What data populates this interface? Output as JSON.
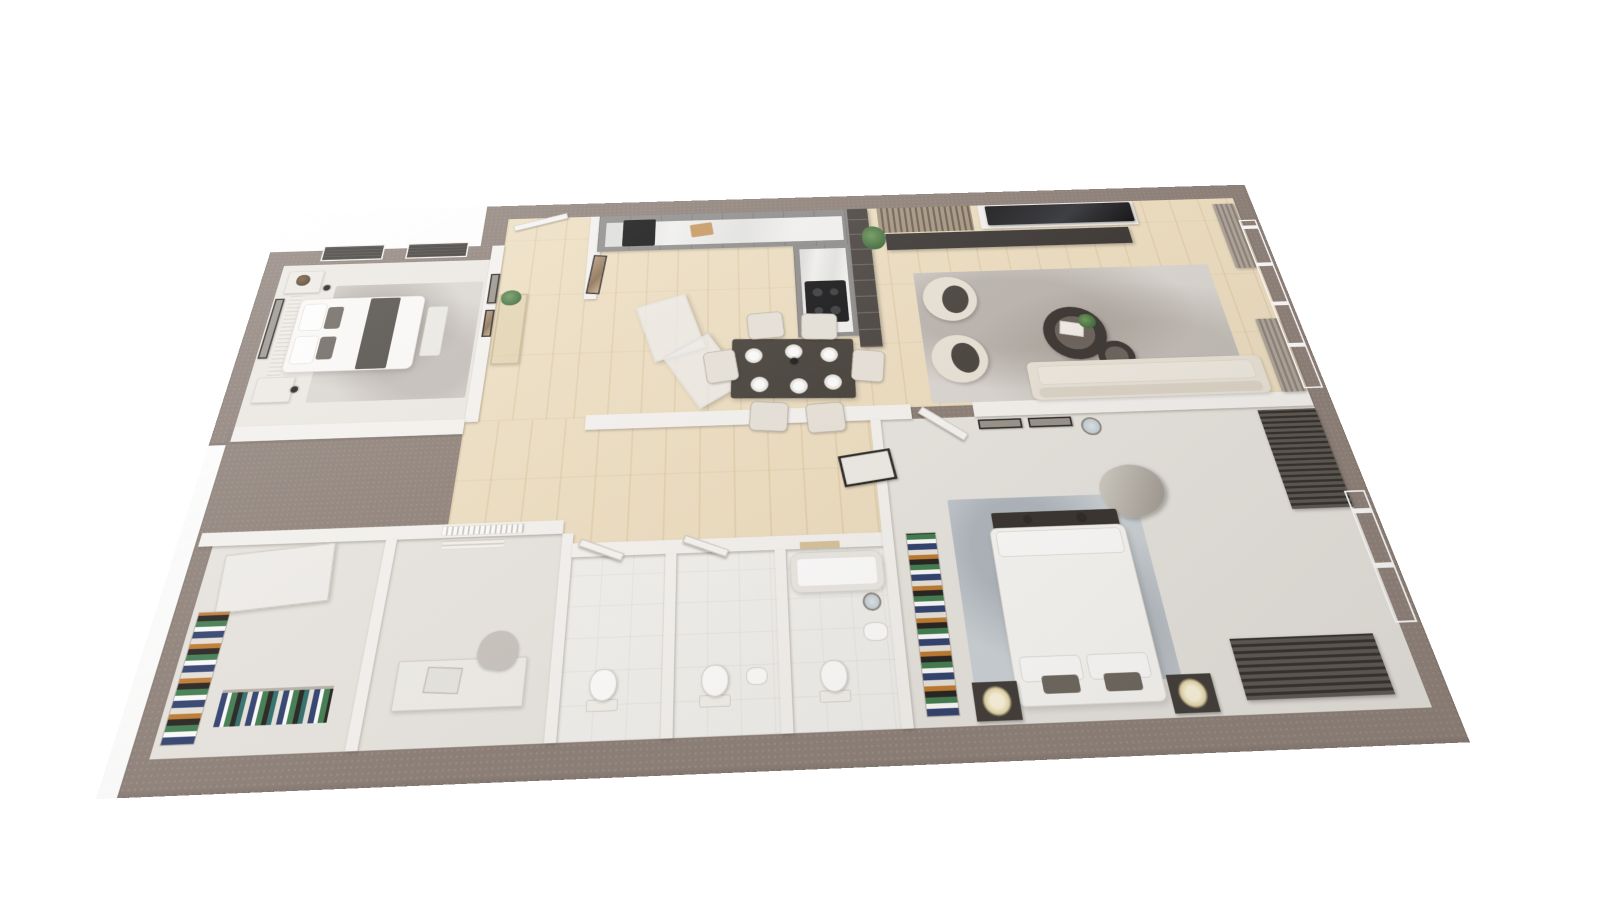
{
  "scene": {
    "description": "3D rendered top-down perspective floor plan of a two-bedroom apartment, no text labels",
    "colors": {
      "page-bg": "#ffffff",
      "wall-outer": "#8d8078",
      "wall-inner": "#f6f4f1",
      "floor-wood": "#efe0c3",
      "floor-carpet": "#edeae5",
      "floor-tile": "#f3f2ef",
      "floor-gray": "#e9e6e1",
      "rug-light": "#dcd8d3",
      "rug-blue": "#cdd4d9",
      "cabinet-gray": "#8f8e8c",
      "counter-white": "#f3f3f1",
      "cream": "#eae4d9"
    }
  },
  "plan": {
    "width": 1340,
    "height": 740,
    "transform": {
      "perspective": 760,
      "rotateX": 25.5,
      "rotateZ": -2.2,
      "scale": 0.86,
      "originX": "50%",
      "originY": "55%"
    }
  },
  "slabs": [
    {
      "name": "slab-top-band",
      "x": 280,
      "y": 0,
      "w": 1060,
      "h": 360
    },
    {
      "name": "slab-left-block",
      "x": 0,
      "y": 70,
      "w": 300,
      "h": 290
    },
    {
      "name": "slab-bottom-band",
      "x": 20,
      "y": 340,
      "w": 1320,
      "h": 400
    }
  ],
  "floors": [
    {
      "name": "bedroom-left-floor",
      "fill": "carpet",
      "x": 24,
      "y": 94,
      "w": 272,
      "h": 246
    },
    {
      "name": "entry-hall-floor",
      "fill": "wood",
      "x": 312,
      "y": 24,
      "w": 113,
      "h": 316
    },
    {
      "name": "kitchen-living-floor",
      "fill": "wood",
      "x": 425,
      "y": 24,
      "w": 891,
      "h": 316
    },
    {
      "name": "corridor-floor",
      "fill": "wood",
      "x": 296,
      "y": 340,
      "w": 484,
      "h": 170
    },
    {
      "name": "closet-room-floor",
      "fill": "gray",
      "x": 40,
      "y": 486,
      "w": 190,
      "h": 220
    },
    {
      "name": "study-room-floor",
      "fill": "gray",
      "x": 242,
      "y": 486,
      "w": 183,
      "h": 220
    },
    {
      "name": "bathroom1-floor",
      "fill": "tile",
      "x": 437,
      "y": 514,
      "w": 103,
      "h": 192
    },
    {
      "name": "bathroom2-floor",
      "fill": "tile",
      "x": 552,
      "y": 514,
      "w": 108,
      "h": 192
    },
    {
      "name": "bathroom3-floor",
      "fill": "tile",
      "x": 672,
      "y": 514,
      "w": 108,
      "h": 192
    },
    {
      "name": "master-bedroom-floor",
      "fill": "gray",
      "x": 792,
      "y": 356,
      "w": 524,
      "h": 350
    }
  ],
  "walls": [
    {
      "name": "wall-hall-left",
      "x": 296,
      "y": 70,
      "w": 16,
      "h": 270
    },
    {
      "name": "wall-hall-right-upper",
      "x": 425,
      "y": 24,
      "w": 16,
      "h": 140
    },
    {
      "name": "wall-middle-a",
      "x": 24,
      "y": 336,
      "w": 272,
      "h": 20
    },
    {
      "name": "wall-middle-b",
      "x": 440,
      "y": 336,
      "w": 390,
      "h": 20
    },
    {
      "name": "wall-middle-c",
      "x": 905,
      "y": 336,
      "w": 411,
      "h": 20
    },
    {
      "name": "wall-leftblock-top",
      "x": 24,
      "y": 470,
      "w": 401,
      "h": 16
    },
    {
      "name": "wall-closet-study",
      "x": 230,
      "y": 486,
      "w": 12,
      "h": 220
    },
    {
      "name": "wall-study-bath",
      "x": 425,
      "y": 486,
      "w": 12,
      "h": 220
    },
    {
      "name": "wall-bath-top",
      "x": 437,
      "y": 498,
      "w": 343,
      "h": 16
    },
    {
      "name": "wall-bath1-bath2",
      "x": 540,
      "y": 514,
      "w": 12,
      "h": 192
    },
    {
      "name": "wall-bath2-bath3",
      "x": 660,
      "y": 514,
      "w": 12,
      "h": 192
    },
    {
      "name": "wall-bath-master",
      "x": 780,
      "y": 356,
      "w": 12,
      "h": 350
    },
    {
      "name": "wall-tv-backing",
      "x": 958,
      "y": 24,
      "w": 216,
      "h": 42
    }
  ],
  "items": [
    {
      "name": "bedroom-left-accent-panel",
      "type": "accent-stripes",
      "x": 44,
      "y": 112,
      "w": 16,
      "h": 188
    },
    {
      "name": "bedroom-left-rug",
      "type": "rug",
      "x": 100,
      "y": 130,
      "w": 192,
      "h": 176
    },
    {
      "name": "bedroom-left-bed",
      "type": "bed",
      "x": 60,
      "y": 150,
      "w": 160,
      "h": 112
    },
    {
      "name": "bedroom-left-pillow-1",
      "type": "pillow",
      "x": 66,
      "y": 158,
      "w": 30,
      "h": 42
    },
    {
      "name": "bedroom-left-pillow-2",
      "type": "pillow",
      "x": 66,
      "y": 208,
      "w": 30,
      "h": 42
    },
    {
      "name": "bedroom-left-cushion-1",
      "type": "cushion-dark",
      "x": 98,
      "y": 164,
      "w": 20,
      "h": 34
    },
    {
      "name": "bedroom-left-cushion-2",
      "type": "cushion-dark",
      "x": 98,
      "y": 210,
      "w": 20,
      "h": 34
    },
    {
      "name": "bedroom-left-throw",
      "type": "throw",
      "x": 150,
      "y": 152,
      "w": 38,
      "h": 108
    },
    {
      "name": "bedroom-left-bench",
      "type": "bench-light",
      "x": 226,
      "y": 168,
      "w": 26,
      "h": 76
    },
    {
      "name": "bedroom-left-nightstand-1",
      "type": "nightstand",
      "x": 34,
      "y": 104,
      "w": 46,
      "h": 36
    },
    {
      "name": "bedroom-left-nightstand-2",
      "type": "nightstand",
      "x": 34,
      "y": 268,
      "w": 46,
      "h": 36
    },
    {
      "name": "bedroom-left-vase-plant",
      "type": "plant-dark",
      "x": 46,
      "y": 110,
      "w": 18,
      "h": 18
    },
    {
      "name": "bedroom-left-wall-art",
      "type": "frame-dark",
      "x": 26,
      "y": 148,
      "w": 12,
      "h": 92
    },
    {
      "name": "bedroom-left-window-blind-1",
      "type": "blind-dark",
      "x": 70,
      "y": 62,
      "w": 82,
      "h": 26
    },
    {
      "name": "bedroom-left-window-blind-2",
      "type": "blind-dark",
      "x": 182,
      "y": 62,
      "w": 82,
      "h": 26
    },
    {
      "name": "bedroom-left-pendant-1",
      "type": "pendant",
      "x": 84,
      "y": 128,
      "w": 9,
      "h": 9
    },
    {
      "name": "bedroom-left-pendant-2",
      "type": "pendant",
      "x": 78,
      "y": 282,
      "w": 9,
      "h": 9
    },
    {
      "name": "entry-door-leaf",
      "type": "door-leaf",
      "x": 320,
      "y": 26,
      "w": 74,
      "h": 10,
      "rot": -16
    },
    {
      "name": "entry-console-table",
      "type": "console-glass",
      "x": 316,
      "y": 152,
      "w": 36,
      "h": 108
    },
    {
      "name": "entry-console-plant",
      "type": "plant",
      "x": 318,
      "y": 146,
      "w": 26,
      "h": 24
    },
    {
      "name": "entry-wall-art-1",
      "type": "frame-dark",
      "x": 300,
      "y": 118,
      "w": 12,
      "h": 48
    },
    {
      "name": "entry-wall-art-2",
      "type": "frame-art",
      "x": 300,
      "y": 176,
      "w": 12,
      "h": 42
    },
    {
      "name": "entry-leaning-art",
      "type": "frame-art",
      "x": 430,
      "y": 92,
      "w": 18,
      "h": 64,
      "rot": 6
    },
    {
      "name": "kitchen-cabinet-run",
      "type": "cabinet",
      "x": 437,
      "y": 24,
      "w": 340,
      "h": 62
    },
    {
      "name": "kitchen-countertop",
      "type": "counter",
      "x": 447,
      "y": 36,
      "w": 322,
      "h": 42
    },
    {
      "name": "kitchen-oven",
      "type": "appliance",
      "x": 470,
      "y": 32,
      "w": 44,
      "h": 46
    },
    {
      "name": "kitchen-cutting-board",
      "type": "board",
      "x": 562,
      "y": 42,
      "w": 30,
      "h": 22,
      "rot": -8
    },
    {
      "name": "kitchen-cabinet-return",
      "type": "cabinet",
      "x": 700,
      "y": 86,
      "w": 77,
      "h": 148
    },
    {
      "name": "kitchen-counter-return",
      "type": "counter",
      "x": 708,
      "y": 92,
      "w": 62,
      "h": 136
    },
    {
      "name": "kitchen-hob",
      "type": "hob",
      "x": 712,
      "y": 146,
      "w": 54,
      "h": 66
    },
    {
      "name": "kitchen-shelf-partition",
      "type": "partition",
      "x": 777,
      "y": 24,
      "w": 28,
      "h": 228
    },
    {
      "name": "kitchen-open-door-1",
      "type": "door-glass",
      "x": 505,
      "y": 168,
      "w": 66,
      "h": 88,
      "rot": -18
    },
    {
      "name": "kitchen-open-door-2",
      "type": "door-glass",
      "x": 548,
      "y": 234,
      "w": 66,
      "h": 88,
      "rot": -32
    },
    {
      "name": "dining-table",
      "type": "table-dark",
      "x": 615,
      "y": 236,
      "w": 152,
      "h": 86,
      "rot": 2
    },
    {
      "name": "dining-chair-1",
      "type": "chair",
      "x": 636,
      "y": 194,
      "w": 46,
      "h": 40,
      "rot": -4
    },
    {
      "name": "dining-chair-2",
      "type": "chair",
      "x": 704,
      "y": 198,
      "w": 46,
      "h": 40,
      "rot": 3
    },
    {
      "name": "dining-chair-3",
      "type": "chair",
      "x": 636,
      "y": 326,
      "w": 46,
      "h": 40,
      "rot": 5
    },
    {
      "name": "dining-chair-4",
      "type": "chair",
      "x": 704,
      "y": 330,
      "w": 46,
      "h": 40,
      "rot": -3
    },
    {
      "name": "dining-chair-5",
      "type": "chair",
      "x": 582,
      "y": 250,
      "w": 40,
      "h": 46,
      "rot": -8
    },
    {
      "name": "dining-chair-6",
      "type": "chair",
      "x": 764,
      "y": 256,
      "w": 40,
      "h": 46,
      "rot": 8
    },
    {
      "name": "dining-plate-1",
      "type": "plate",
      "x": 632,
      "y": 248,
      "w": 22,
      "h": 22
    },
    {
      "name": "dining-plate-2",
      "type": "plate",
      "x": 682,
      "y": 244,
      "w": 22,
      "h": 22
    },
    {
      "name": "dining-plate-3",
      "type": "plate",
      "x": 726,
      "y": 250,
      "w": 22,
      "h": 22
    },
    {
      "name": "dining-plate-4",
      "type": "plate",
      "x": 638,
      "y": 290,
      "w": 22,
      "h": 22
    },
    {
      "name": "dining-plate-5",
      "type": "plate",
      "x": 686,
      "y": 294,
      "w": 22,
      "h": 22
    },
    {
      "name": "dining-plate-6",
      "type": "plate",
      "x": 728,
      "y": 290,
      "w": 22,
      "h": 22
    },
    {
      "name": "dining-pendant-light",
      "type": "pendant",
      "x": 688,
      "y": 264,
      "w": 10,
      "h": 10
    },
    {
      "name": "living-slat-panel",
      "type": "slats-v",
      "x": 818,
      "y": 24,
      "w": 130,
      "h": 44
    },
    {
      "name": "living-tv",
      "type": "tv",
      "x": 968,
      "y": 26,
      "w": 202,
      "h": 34
    },
    {
      "name": "living-media-console",
      "type": "console-dark",
      "x": 826,
      "y": 70,
      "w": 332,
      "h": 28
    },
    {
      "name": "living-plant",
      "type": "plant",
      "x": 794,
      "y": 56,
      "w": 32,
      "h": 40
    },
    {
      "name": "living-rug",
      "type": "rug",
      "x": 856,
      "y": 138,
      "w": 392,
      "h": 198
    },
    {
      "name": "living-armchair-1",
      "type": "armchair",
      "x": 864,
      "y": 146,
      "w": 70,
      "h": 70,
      "rot": 10
    },
    {
      "name": "living-armchair-2",
      "type": "armchair",
      "x": 864,
      "y": 238,
      "w": 70,
      "h": 70,
      "rot": -8
    },
    {
      "name": "living-coffee-table-large",
      "type": "round-table",
      "x": 1010,
      "y": 200,
      "w": 80,
      "h": 80
    },
    {
      "name": "living-coffee-table-small",
      "type": "round-table",
      "x": 1072,
      "y": 254,
      "w": 46,
      "h": 46
    },
    {
      "name": "living-table-books",
      "type": "book",
      "x": 1032,
      "y": 224,
      "w": 30,
      "h": 20,
      "rot": 12
    },
    {
      "name": "living-table-plant",
      "type": "plant",
      "x": 1058,
      "y": 212,
      "w": 22,
      "h": 22
    },
    {
      "name": "living-sofa",
      "type": "sofa",
      "x": 980,
      "y": 282,
      "w": 292,
      "h": 54
    },
    {
      "name": "living-curtain-1",
      "type": "curtain",
      "x": 1284,
      "y": 34,
      "w": 30,
      "h": 112
    },
    {
      "name": "living-curtain-2",
      "type": "curtain",
      "x": 1284,
      "y": 228,
      "w": 30,
      "h": 108
    },
    {
      "name": "living-window",
      "type": "window-sky",
      "x": 1312,
      "y": 64,
      "w": 24,
      "h": 268
    },
    {
      "name": "master-rug",
      "type": "rug-blue",
      "x": 858,
      "y": 462,
      "w": 214,
      "h": 206
    },
    {
      "name": "master-wardrobe-clothes",
      "type": "clothes-v",
      "x": 806,
      "y": 500,
      "w": 34,
      "h": 196
    },
    {
      "name": "master-door-leaf",
      "type": "door-leaf",
      "x": 834,
      "y": 358,
      "w": 64,
      "h": 11,
      "rot": 38
    },
    {
      "name": "master-wall-art-1",
      "type": "frame-dark",
      "x": 908,
      "y": 360,
      "w": 52,
      "h": 13
    },
    {
      "name": "master-wall-art-2",
      "type": "frame-dark",
      "x": 968,
      "y": 360,
      "w": 52,
      "h": 13
    },
    {
      "name": "master-round-mirror",
      "type": "mirror",
      "x": 1030,
      "y": 362,
      "w": 24,
      "h": 24
    },
    {
      "name": "master-accent-chair",
      "type": "chair-metal",
      "x": 1034,
      "y": 426,
      "w": 74,
      "h": 64,
      "rot": -20
    },
    {
      "name": "master-louver-right",
      "type": "slats-h",
      "x": 1246,
      "y": 360,
      "w": 70,
      "h": 128
    },
    {
      "name": "master-window",
      "type": "window-sky",
      "x": 1312,
      "y": 468,
      "w": 24,
      "h": 152
    },
    {
      "name": "master-louver-bottom",
      "type": "slats-h",
      "x": 1132,
      "y": 630,
      "w": 152,
      "h": 62
    },
    {
      "name": "master-foot-bench",
      "type": "bench-dark",
      "x": 905,
      "y": 480,
      "w": 142,
      "h": 20
    },
    {
      "name": "master-bed",
      "type": "bed",
      "x": 900,
      "y": 498,
      "w": 152,
      "h": 192
    },
    {
      "name": "master-duvet-fold",
      "type": "pillow",
      "x": 906,
      "y": 502,
      "w": 140,
      "h": 30
    },
    {
      "name": "master-pillow-1",
      "type": "pillow",
      "x": 908,
      "y": 640,
      "w": 64,
      "h": 26
    },
    {
      "name": "master-pillow-2",
      "type": "pillow",
      "x": 978,
      "y": 640,
      "w": 64,
      "h": 26
    },
    {
      "name": "master-cushion-1",
      "type": "cushion-dark",
      "x": 928,
      "y": 660,
      "w": 38,
      "h": 18
    },
    {
      "name": "master-cushion-2",
      "type": "cushion-dark",
      "x": 992,
      "y": 660,
      "w": 38,
      "h": 18
    },
    {
      "name": "master-nightstand-1",
      "type": "nightstand-dark",
      "x": 856,
      "y": 664,
      "w": 46,
      "h": 38
    },
    {
      "name": "master-nightstand-2",
      "type": "nightstand-dark",
      "x": 1056,
      "y": 664,
      "w": 46,
      "h": 38
    },
    {
      "name": "master-lamp-1",
      "type": "lamp",
      "x": 864,
      "y": 668,
      "w": 30,
      "h": 30
    },
    {
      "name": "master-lamp-2",
      "type": "lamp",
      "x": 1064,
      "y": 668,
      "w": 30,
      "h": 30
    },
    {
      "name": "master-bench-decor-1",
      "type": "dot-dark",
      "x": 940,
      "y": 484,
      "w": 10,
      "h": 10
    },
    {
      "name": "master-bench-decor-2",
      "type": "dot-dark",
      "x": 1000,
      "y": 483,
      "w": 12,
      "h": 12
    },
    {
      "name": "corridor-mirror-frame",
      "type": "frame-hatch",
      "x": 740,
      "y": 398,
      "w": 62,
      "h": 40,
      "rot": -8
    },
    {
      "name": "bathroom1-cistern",
      "type": "cistern",
      "x": 464,
      "y": 666,
      "w": 32,
      "h": 12
    },
    {
      "name": "bathroom1-toilet",
      "type": "toilet",
      "x": 466,
      "y": 636,
      "w": 28,
      "h": 32
    },
    {
      "name": "bathroom1-door-leaf",
      "type": "door-leaf",
      "x": 443,
      "y": 502,
      "w": 52,
      "h": 9,
      "rot": 22
    },
    {
      "name": "bathroom2-cistern",
      "type": "cistern",
      "x": 578,
      "y": 666,
      "w": 32,
      "h": 12
    },
    {
      "name": "bathroom2-toilet",
      "type": "toilet",
      "x": 580,
      "y": 636,
      "w": 28,
      "h": 32
    },
    {
      "name": "bathroom2-sink",
      "type": "sink",
      "x": 626,
      "y": 640,
      "w": 22,
      "h": 18
    },
    {
      "name": "bathroom2-door-leaf",
      "type": "door-leaf",
      "x": 558,
      "y": 502,
      "w": 52,
      "h": 9,
      "rot": 22
    },
    {
      "name": "bathroom3-bathtub",
      "type": "tub",
      "x": 676,
      "y": 518,
      "w": 102,
      "h": 46
    },
    {
      "name": "bathroom3-shelf-niche",
      "type": "shelf-tan",
      "x": 688,
      "y": 506,
      "w": 44,
      "h": 8
    },
    {
      "name": "bathroom3-sink",
      "type": "sink",
      "x": 750,
      "y": 598,
      "w": 26,
      "h": 20
    },
    {
      "name": "bathroom3-mirror",
      "type": "mirror",
      "x": 752,
      "y": 566,
      "w": 20,
      "h": 20
    },
    {
      "name": "bathroom3-cistern",
      "type": "cistern",
      "x": 700,
      "y": 666,
      "w": 32,
      "h": 12
    },
    {
      "name": "bathroom3-toilet",
      "type": "toilet",
      "x": 702,
      "y": 636,
      "w": 28,
      "h": 32
    },
    {
      "name": "closet-wardrobe-door",
      "type": "wardrobe-door",
      "x": 60,
      "y": 492,
      "w": 118,
      "h": 66,
      "rot": -5
    },
    {
      "name": "closet-folded-clothes",
      "type": "clothes-v",
      "x": 46,
      "y": 560,
      "w": 34,
      "h": 134
    },
    {
      "name": "closet-hanging-clothes",
      "type": "clothes-h",
      "x": 94,
      "y": 642,
      "w": 112,
      "h": 36
    },
    {
      "name": "study-wall-vent",
      "type": "vent",
      "x": 292,
      "y": 488,
      "w": 70,
      "h": 12
    },
    {
      "name": "study-window-blind",
      "type": "blind-light",
      "x": 290,
      "y": 472,
      "w": 92,
      "h": 12
    },
    {
      "name": "study-desk",
      "type": "desk",
      "x": 268,
      "y": 620,
      "w": 132,
      "h": 50
    },
    {
      "name": "study-laptop",
      "type": "laptop",
      "x": 298,
      "y": 628,
      "w": 36,
      "h": 26,
      "rot": 4
    },
    {
      "name": "study-chair",
      "type": "chair-gray",
      "x": 348,
      "y": 592,
      "w": 42,
      "h": 40,
      "rot": 10
    }
  ]
}
